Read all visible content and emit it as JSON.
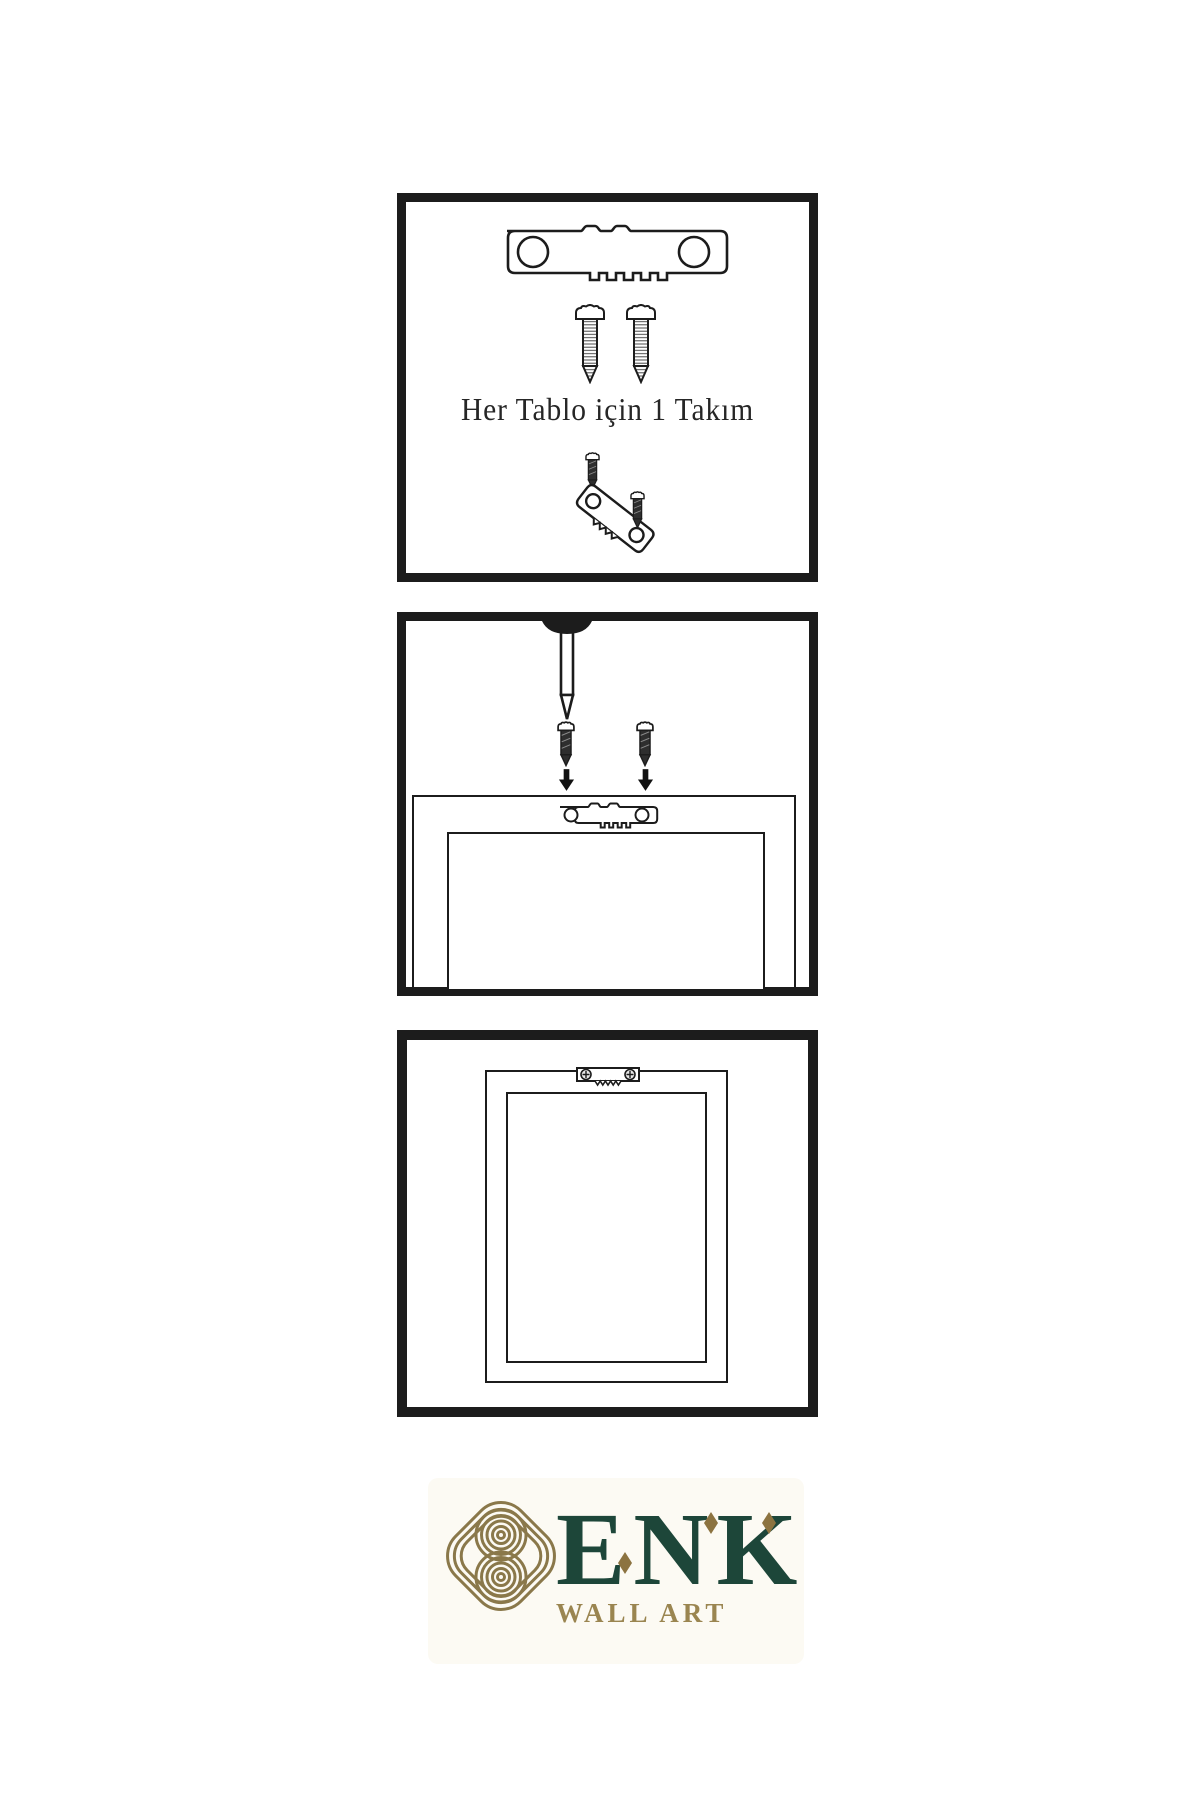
{
  "page": {
    "background": "#ffffff"
  },
  "colors": {
    "line": "#1c1c1c",
    "screw_fill": "#2e2e2e",
    "logo_green": "#1d4639",
    "logo_gold": "#8a784a",
    "tagline_gold": "#9a8550",
    "diamond_gold": "#8c7340",
    "logo_background": "#fcfaf3"
  },
  "panels": {
    "kit": {
      "caption": "Her Tablo için 1 Takım",
      "icons": [
        "sawtooth-hanger-icon",
        "screw-icon",
        "screw-icon",
        "dark-screw-icon",
        "tilted-sawtooth-hanger-icon",
        "dark-screw-icon"
      ]
    },
    "mount": {
      "icons": [
        "nail-icon",
        "dark-screw-icon",
        "dark-screw-icon",
        "down-arrow-icon",
        "down-arrow-icon",
        "sawtooth-hanger-icon",
        "frame-back-view"
      ]
    },
    "hang": {
      "icons": [
        "sawtooth-hanger-icon",
        "hanging-frame-front-view"
      ]
    }
  },
  "logo": {
    "brand": "ENK",
    "tagline": "WALL ART",
    "mark": "knot-icon"
  }
}
